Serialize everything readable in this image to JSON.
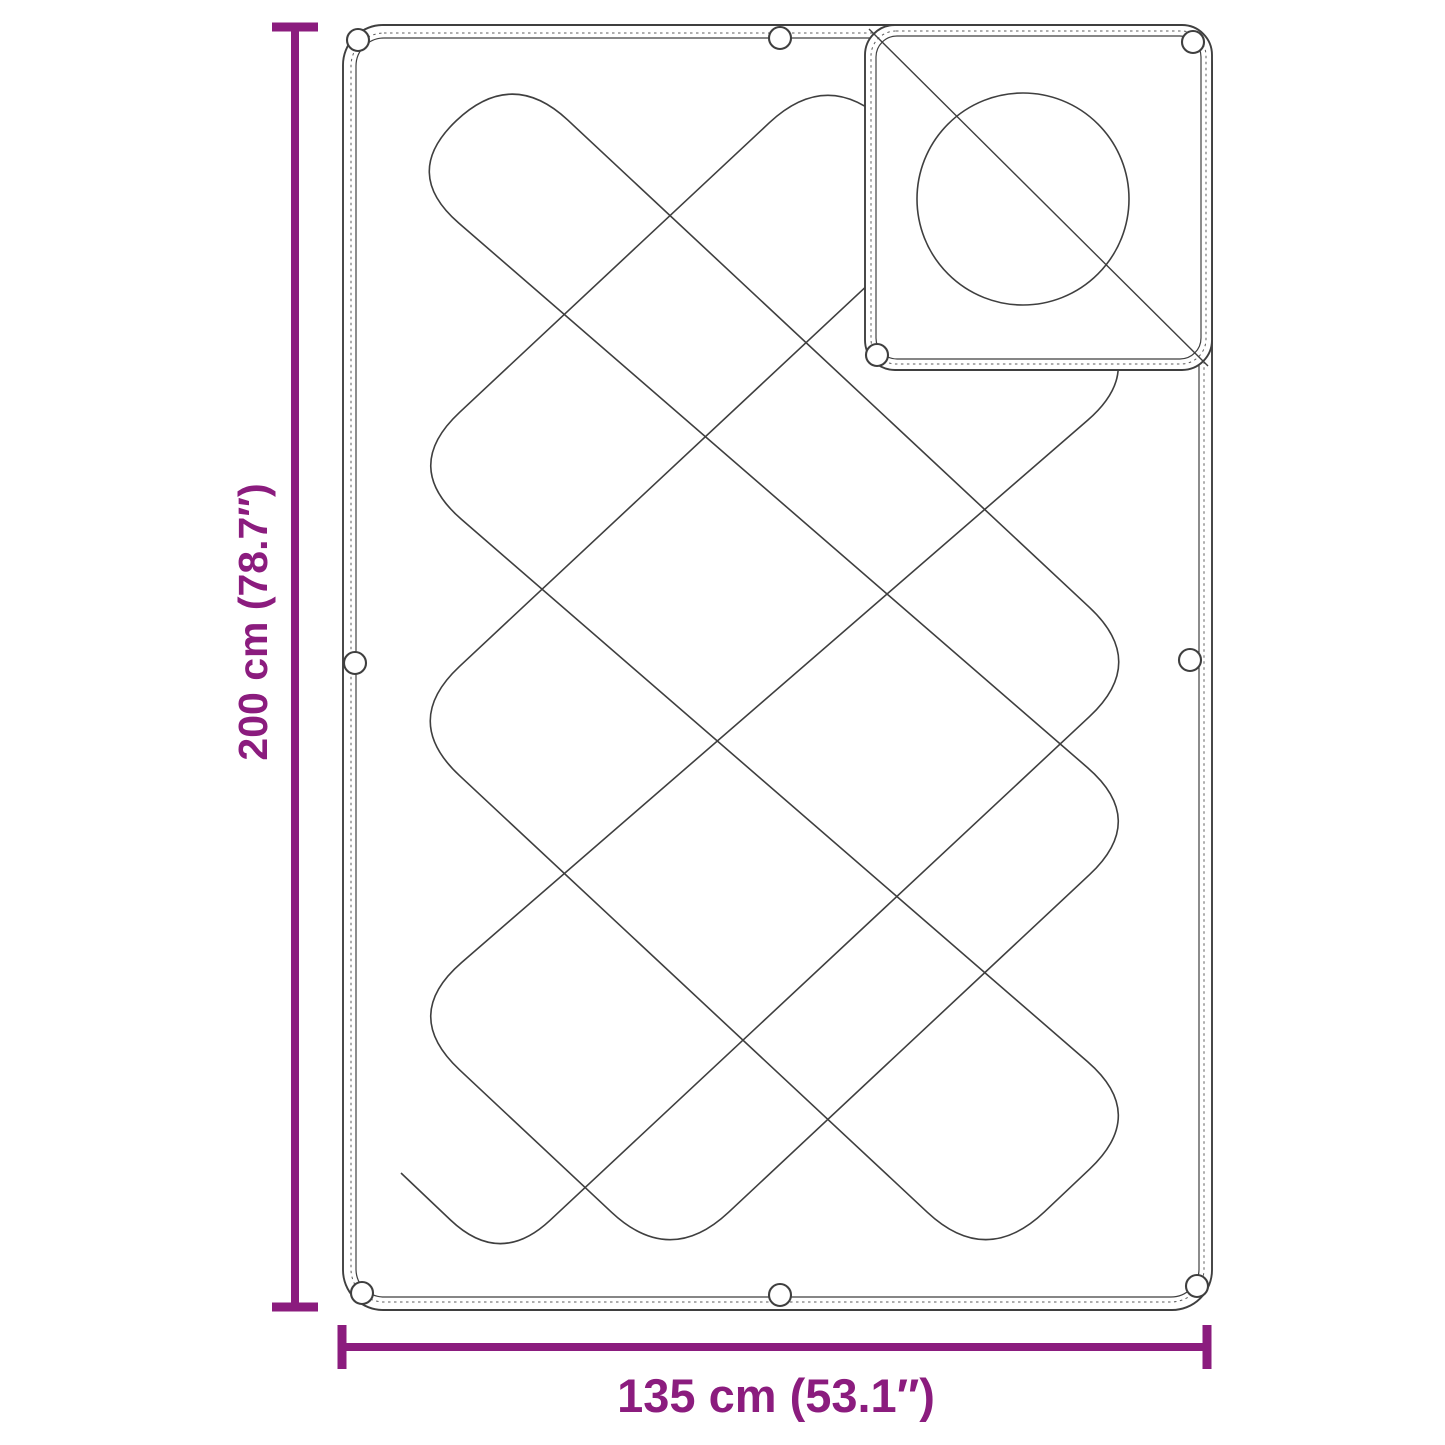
{
  "diagram_labels": {
    "height": "200 cm (78.7″)",
    "width": "135 cm (53.1″)"
  },
  "colors": {
    "dimension_accent": "#8b1c7e",
    "line_art": "#3f3f3f",
    "background": "#ffffff"
  }
}
